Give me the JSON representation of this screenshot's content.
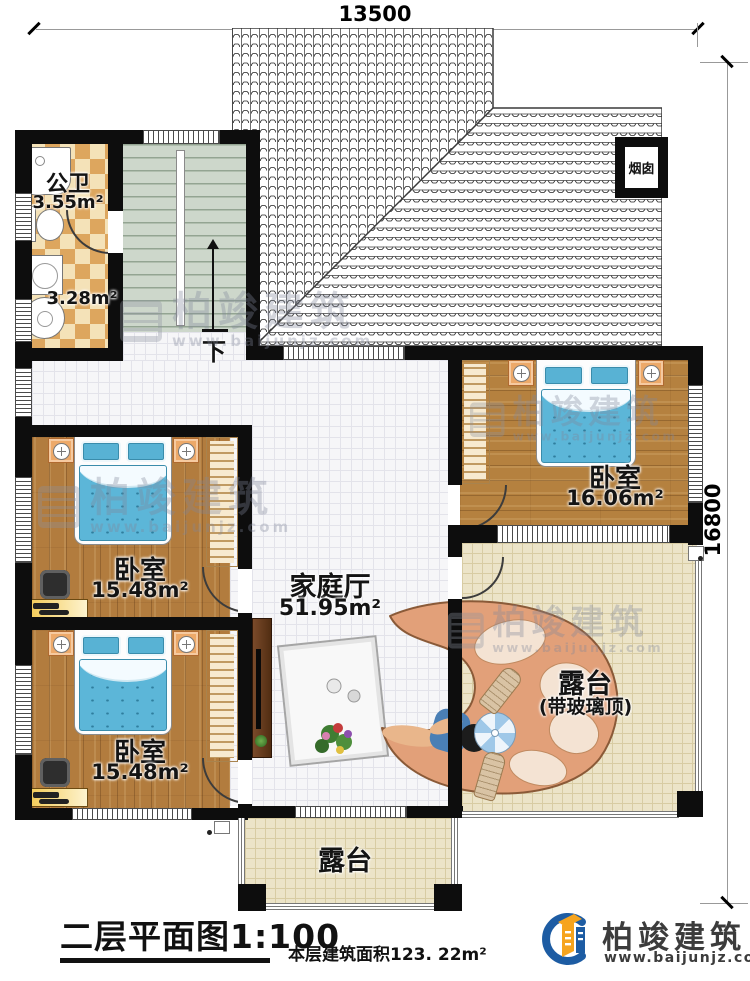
{
  "dimensions": {
    "width": "13500",
    "height": "16800"
  },
  "rooms": {
    "bath": {
      "name": "公卫",
      "area": "3.55m²"
    },
    "bath2": {
      "area": "3.28m²"
    },
    "bedroom_right": {
      "name": "卧室",
      "area": "16.06m²"
    },
    "bedroom_mid": {
      "name": "卧室",
      "area": "15.48m²"
    },
    "bedroom_bottom": {
      "name": "卧室",
      "area": "15.48m²"
    },
    "family_hall": {
      "name": "家庭厅",
      "area": "51.95m²"
    },
    "terrace_right": {
      "name": "露台",
      "note": "(带玻璃顶)"
    },
    "terrace_bottom": {
      "name": "露台"
    }
  },
  "annotations": {
    "chimney": "烟囱",
    "stairs_down": "下"
  },
  "footer": {
    "plan_title": "二层平面图1:100",
    "floor_area": "本层建筑面积123. 22m²"
  },
  "brand": {
    "name": "柏竣建筑",
    "site": "www.baijunjz.com"
  },
  "watermark": {
    "name": "柏竣建筑",
    "site": "www.baijunjz.com"
  },
  "colors": {
    "wall": "#0d0d0d",
    "wood_floor": "#b27c3e",
    "mattress_blue": "#5cb6d8",
    "checker_tan": "#dda65e",
    "stair_green": "#cdd7cb",
    "terrace_beige": "#ece4c8",
    "brand_blue": "#1d5ca3",
    "brand_orange": "#f6a41e"
  }
}
